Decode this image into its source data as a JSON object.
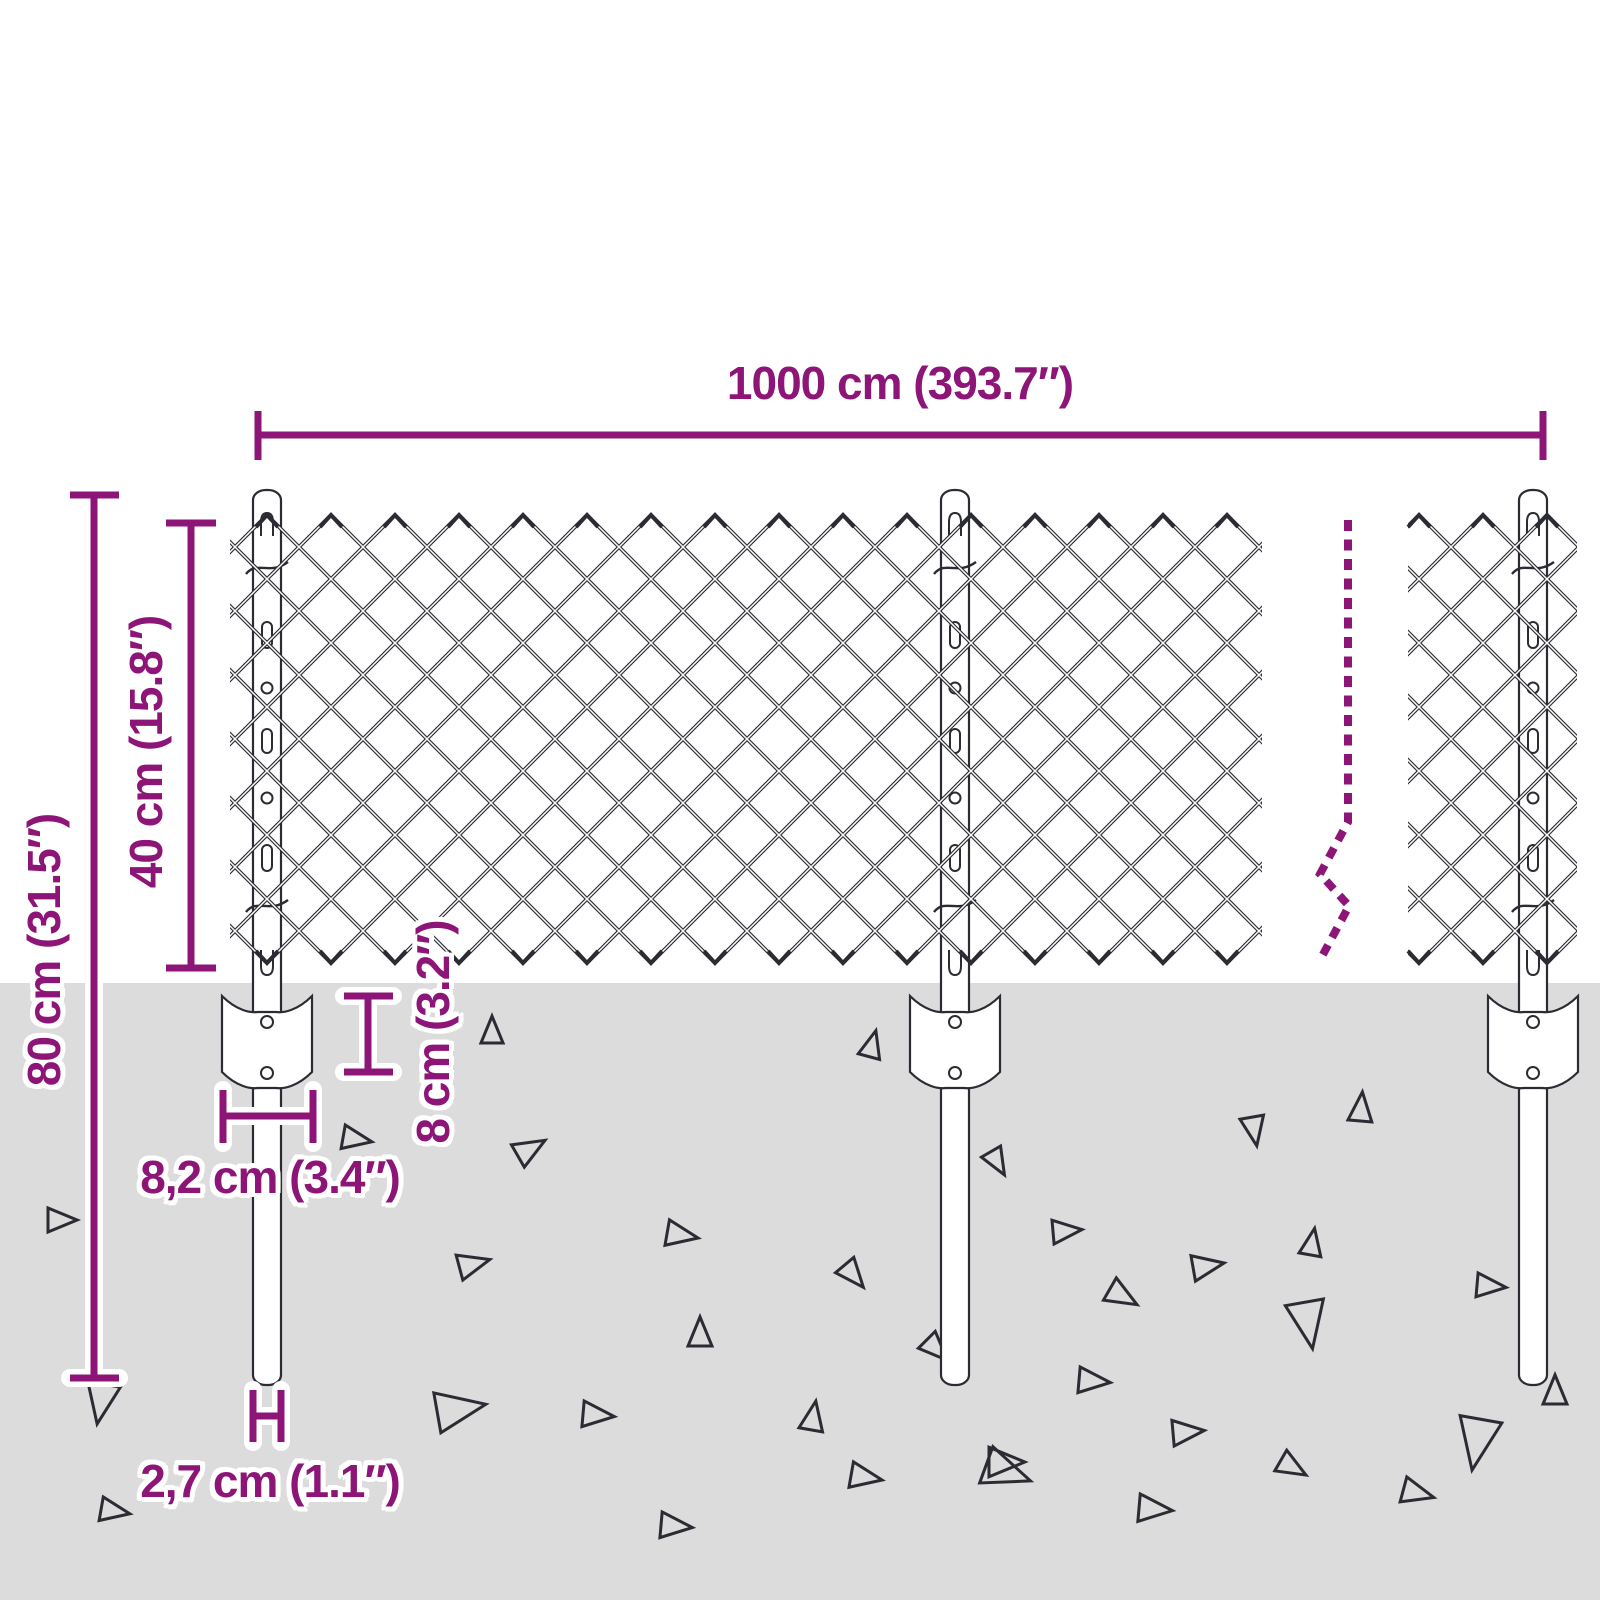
{
  "title": "Chain-link fence installation dimensions diagram",
  "colors": {
    "accent": "#8C1577",
    "line": "#2B2B33",
    "ground": "#DCDCDC",
    "post_fill": "#FFFFFF"
  },
  "labels": {
    "fence_length": "1000 cm (393.7″)",
    "post_total_height": "80 cm (31.5″)",
    "mesh_height": "40 cm (15.8″)",
    "bracket_depth": "8 cm (3.2″)",
    "bracket_width": "8,2 cm (3.4″)",
    "post_diameter": "2,7 cm (1.1″)"
  },
  "ground_debris": [
    {
      "x": 492,
      "y": 1031,
      "s": 24,
      "r": 0
    },
    {
      "x": 872,
      "y": 1045,
      "s": 24,
      "r": 15
    },
    {
      "x": 61,
      "y": 1220,
      "s": 26,
      "r": 90
    },
    {
      "x": 356,
      "y": 1139,
      "s": 26,
      "r": 100
    },
    {
      "x": 530,
      "y": 1149,
      "s": 28,
      "r": 60
    },
    {
      "x": 997,
      "y": 1162,
      "s": 24,
      "r": 150
    },
    {
      "x": 681,
      "y": 1235,
      "s": 28,
      "r": 100
    },
    {
      "x": 473,
      "y": 1264,
      "s": 28,
      "r": 75
    },
    {
      "x": 853,
      "y": 1275,
      "s": 26,
      "r": 140
    },
    {
      "x": 700,
      "y": 1333,
      "s": 26,
      "r": 0
    },
    {
      "x": 936,
      "y": 1349,
      "s": 26,
      "r": 135
    },
    {
      "x": 459,
      "y": 1409,
      "s": 44,
      "r": 80
    },
    {
      "x": 597,
      "y": 1415,
      "s": 28,
      "r": 95
    },
    {
      "x": 813,
      "y": 1417,
      "s": 26,
      "r": 10
    },
    {
      "x": 865,
      "y": 1477,
      "s": 28,
      "r": 100
    },
    {
      "x": 1006,
      "y": 1472,
      "s": 42,
      "r": 110
    },
    {
      "x": 675,
      "y": 1526,
      "s": 28,
      "r": 95
    },
    {
      "x": 101,
      "y": 1402,
      "s": 36,
      "r": 190
    },
    {
      "x": 114,
      "y": 1511,
      "s": 26,
      "r": 100
    },
    {
      "x": 1361,
      "y": 1108,
      "s": 26,
      "r": 5
    },
    {
      "x": 1254,
      "y": 1130,
      "s": 26,
      "r": 170
    },
    {
      "x": 1066,
      "y": 1231,
      "s": 26,
      "r": 85
    },
    {
      "x": 1312,
      "y": 1243,
      "s": 24,
      "r": 10
    },
    {
      "x": 1207,
      "y": 1266,
      "s": 28,
      "r": 80
    },
    {
      "x": 1122,
      "y": 1296,
      "s": 28,
      "r": 120
    },
    {
      "x": 1490,
      "y": 1286,
      "s": 26,
      "r": 95
    },
    {
      "x": 1308,
      "y": 1323,
      "s": 42,
      "r": 170
    },
    {
      "x": 1093,
      "y": 1381,
      "s": 28,
      "r": 95
    },
    {
      "x": 1555,
      "y": 1391,
      "s": 26,
      "r": 0
    },
    {
      "x": 1187,
      "y": 1432,
      "s": 28,
      "r": 85
    },
    {
      "x": 1477,
      "y": 1442,
      "s": 46,
      "r": 190
    },
    {
      "x": 1292,
      "y": 1467,
      "s": 26,
      "r": 120
    },
    {
      "x": 1417,
      "y": 1493,
      "s": 28,
      "r": 105
    },
    {
      "x": 1154,
      "y": 1509,
      "s": 30,
      "r": 95
    },
    {
      "x": 1005,
      "y": 1462,
      "s": 32,
      "r": 90
    }
  ]
}
